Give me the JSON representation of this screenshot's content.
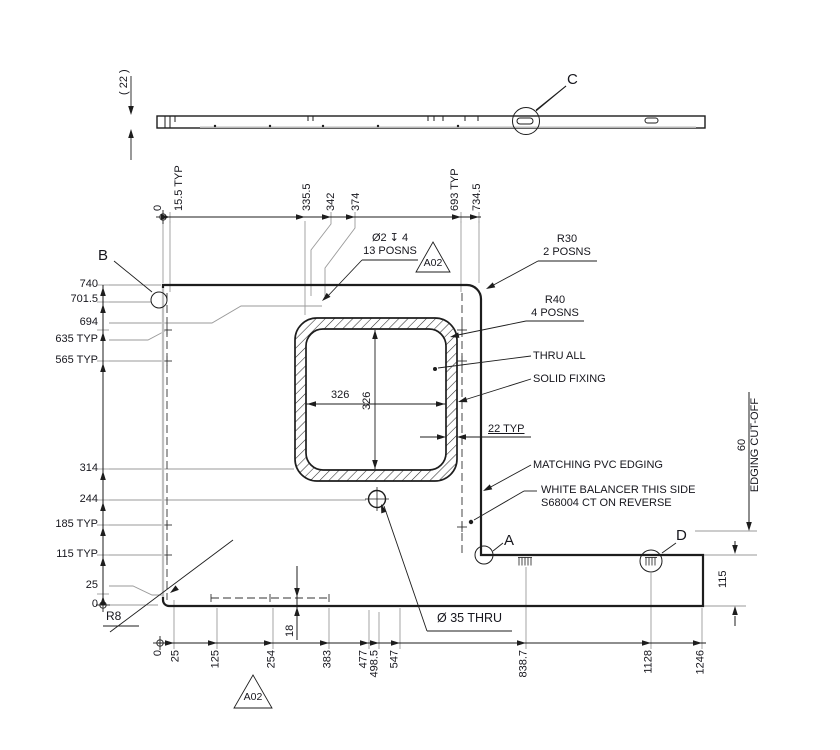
{
  "profile": {
    "thickness": "( 22 )"
  },
  "dims": {
    "top": [
      "0",
      "15.5 TYP",
      "335.5",
      "342",
      "374",
      "693 TYP",
      "734.5"
    ],
    "left": [
      "740",
      "701.5",
      "694",
      "635 TYP",
      "565 TYP",
      "314",
      "244",
      "185 TYP",
      "115 TYP",
      "25",
      "0"
    ],
    "bottom": [
      "0",
      "25",
      "125",
      "254",
      "383",
      "477",
      "498.5",
      "547",
      "838.7",
      "1128",
      "1246"
    ],
    "cutout_width": "326",
    "cutout_height": "326",
    "ring_thickness": "22 TYP",
    "slot_offset": "18",
    "edging_value": "60",
    "edging_label": "EDGING CUT-OFF",
    "tab_height": "115"
  },
  "annotations": {
    "hole_pattern": {
      "line1": "Ø2 ↧ 4",
      "line2": "13 POSNS",
      "flag": "A02"
    },
    "corner_r30": {
      "line1": "R30",
      "line2": "2 POSNS"
    },
    "corner_r40": {
      "line1": "R40",
      "line2": "4 POSNS"
    },
    "thru_all": "THRU ALL",
    "solid_fixing": "SOLID FIXING",
    "pvc_edging": "MATCHING PVC EDGING",
    "balancer_line1": "WHITE BALANCER THIS SIDE",
    "balancer_line2": "S68004 CT ON REVERSE",
    "big_hole": "Ø 35 THRU",
    "corner_r8": "R8",
    "flag_bottom": "A02"
  },
  "callouts": {
    "a": "A",
    "b": "B",
    "c": "C",
    "d": "D"
  }
}
